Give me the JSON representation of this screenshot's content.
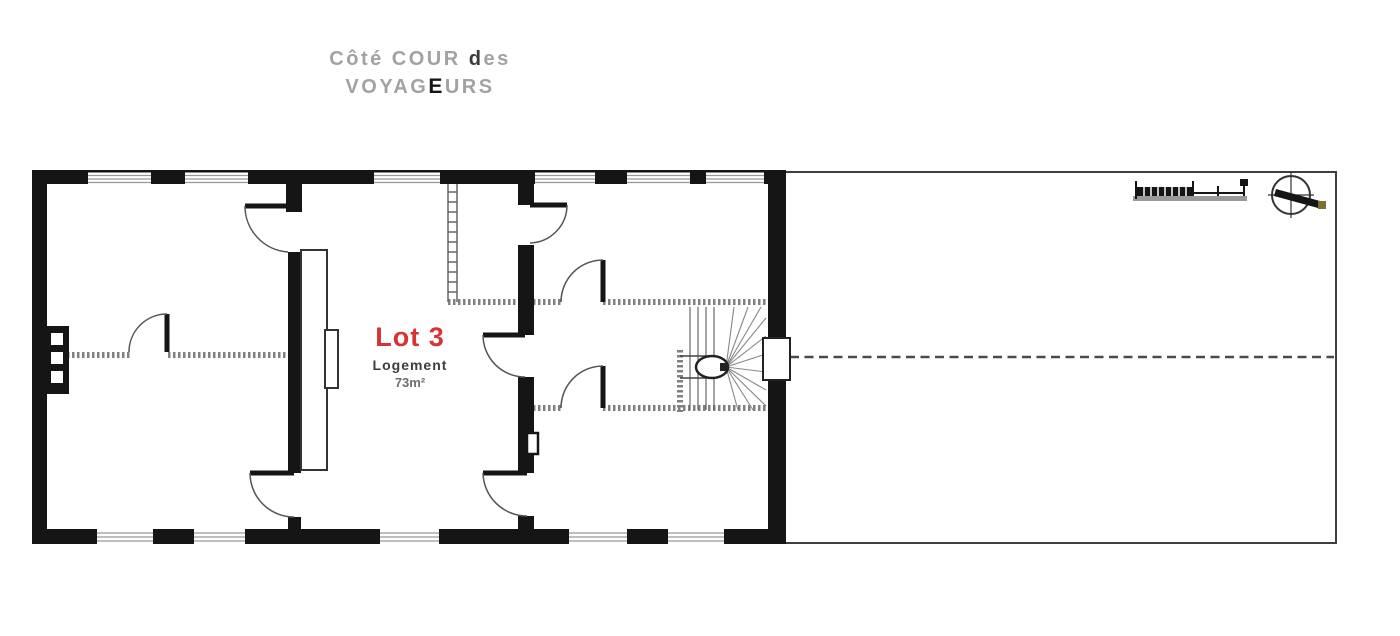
{
  "header": {
    "line1_pre": "Côté COUR ",
    "line1_em": "d",
    "line1_post": "es",
    "line2_pre": "VOYAG",
    "line2_em": "E",
    "line2_post": "URS"
  },
  "plan": {
    "lot_label": "Lot 3",
    "lot_type": "Logement",
    "lot_area": "73m²"
  },
  "icons": {
    "compass": "compass-north-arrow-icon",
    "scale_bar": "graphic-scale-bar"
  },
  "colors": {
    "wall_black": "#151515",
    "lot_red": "#d63434",
    "header_gray": "#a2a2a2",
    "thin_line_gray": "#555555",
    "stipple_wall_gray": "#808080"
  }
}
